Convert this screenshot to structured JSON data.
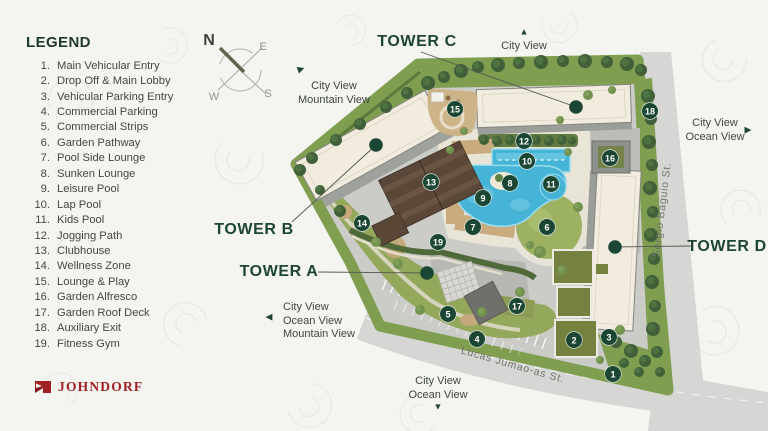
{
  "legend": {
    "title": "LEGEND",
    "items": [
      {
        "num": "1.",
        "label": "Main Vehicular Entry"
      },
      {
        "num": "2.",
        "label": "Drop Off & Main Lobby"
      },
      {
        "num": "3.",
        "label": "Vehicular Parking Entry"
      },
      {
        "num": "4.",
        "label": "Commercial Parking"
      },
      {
        "num": "5.",
        "label": "Commercial Strips"
      },
      {
        "num": "6.",
        "label": "Garden Pathway"
      },
      {
        "num": "7.",
        "label": "Pool Side Lounge"
      },
      {
        "num": "8.",
        "label": "Sunken Lounge"
      },
      {
        "num": "9.",
        "label": "Leisure Pool"
      },
      {
        "num": "10.",
        "label": "Lap Pool"
      },
      {
        "num": "11.",
        "label": "Kids Pool"
      },
      {
        "num": "12.",
        "label": "Jogging Path"
      },
      {
        "num": "13.",
        "label": "Clubhouse"
      },
      {
        "num": "14.",
        "label": "Wellness Zone"
      },
      {
        "num": "15.",
        "label": "Lounge & Play"
      },
      {
        "num": "16.",
        "label": "Garden Alfresco"
      },
      {
        "num": "17.",
        "label": "Garden Roof Deck"
      },
      {
        "num": "18.",
        "label": "Auxiliary Exit"
      },
      {
        "num": "19.",
        "label": "Fitness Gym"
      }
    ]
  },
  "brand": {
    "name": "JOHNDORF"
  },
  "compass": {
    "north": "N",
    "east": "E",
    "west": "W",
    "south": "S"
  },
  "streets": [
    {
      "name": "Lucas Jumao-as St.",
      "x": 512,
      "y": 368,
      "angle": 16
    },
    {
      "name": "Sergio Baguio St.",
      "x": 665,
      "y": 210,
      "angle": -83
    }
  ],
  "towers": [
    {
      "label": "TOWER C",
      "cx": 417,
      "cy": 42,
      "line": [
        421,
        52,
        576,
        107
      ]
    },
    {
      "label": "TOWER B",
      "cx": 254,
      "cy": 230,
      "line": [
        292,
        222,
        376,
        145
      ]
    },
    {
      "label": "TOWER A",
      "cx": 279,
      "cy": 272,
      "line": [
        318,
        272,
        427,
        273
      ]
    },
    {
      "label": "TOWER D",
      "cx": 727,
      "cy": 247,
      "line": [
        691,
        246,
        615,
        247
      ]
    }
  ],
  "views": [
    {
      "id": "view-north",
      "lines": [
        "City View"
      ],
      "arrow": "up",
      "cx": 524,
      "top": 40,
      "arrow_x": 524,
      "arrow_y": 32
    },
    {
      "id": "view-northwest",
      "lines": [
        "City View",
        "Mountain View"
      ],
      "arrow": "up-right",
      "cx": 334,
      "top": 80,
      "arrow_x": 301,
      "arrow_y": 69
    },
    {
      "id": "view-east",
      "lines": [
        "City View",
        "Ocean View"
      ],
      "arrow": "right",
      "cx": 715,
      "top": 117,
      "arrow_x": 748,
      "arrow_y": 130
    },
    {
      "id": "view-west",
      "lines": [
        "City View",
        "Ocean View",
        "Mountain View"
      ],
      "arrow": "left",
      "left": 283,
      "top": 301,
      "arrow_x": 269,
      "arrow_y": 317
    },
    {
      "id": "view-south",
      "lines": [
        "City View",
        "Ocean View"
      ],
      "arrow": "down",
      "cx": 438,
      "top": 375,
      "arrow_x": 438,
      "arrow_y": 407
    }
  ],
  "markers": [
    {
      "num": "1",
      "x": 613,
      "y": 374
    },
    {
      "num": "2",
      "x": 574,
      "y": 340
    },
    {
      "num": "3",
      "x": 609,
      "y": 337
    },
    {
      "num": "4",
      "x": 477,
      "y": 339
    },
    {
      "num": "5",
      "x": 448,
      "y": 314
    },
    {
      "num": "6",
      "x": 547,
      "y": 227
    },
    {
      "num": "7",
      "x": 473,
      "y": 227
    },
    {
      "num": "8",
      "x": 510,
      "y": 183
    },
    {
      "num": "9",
      "x": 483,
      "y": 198
    },
    {
      "num": "10",
      "x": 527,
      "y": 161
    },
    {
      "num": "11",
      "x": 551,
      "y": 184
    },
    {
      "num": "12",
      "x": 524,
      "y": 141
    },
    {
      "num": "13",
      "x": 431,
      "y": 182
    },
    {
      "num": "14",
      "x": 362,
      "y": 223
    },
    {
      "num": "15",
      "x": 455,
      "y": 109
    },
    {
      "num": "16",
      "x": 610,
      "y": 158
    },
    {
      "num": "17",
      "x": 517,
      "y": 306
    },
    {
      "num": "18",
      "x": 650,
      "y": 111
    },
    {
      "num": "19",
      "x": 438,
      "y": 242
    }
  ],
  "colors": {
    "marker": "#1b4634",
    "tower_label": "#1d4434",
    "brand_red": "#a02024",
    "grass": "#7f9e4f",
    "pool": "#46b4d7",
    "road": "#d6d7d4"
  }
}
